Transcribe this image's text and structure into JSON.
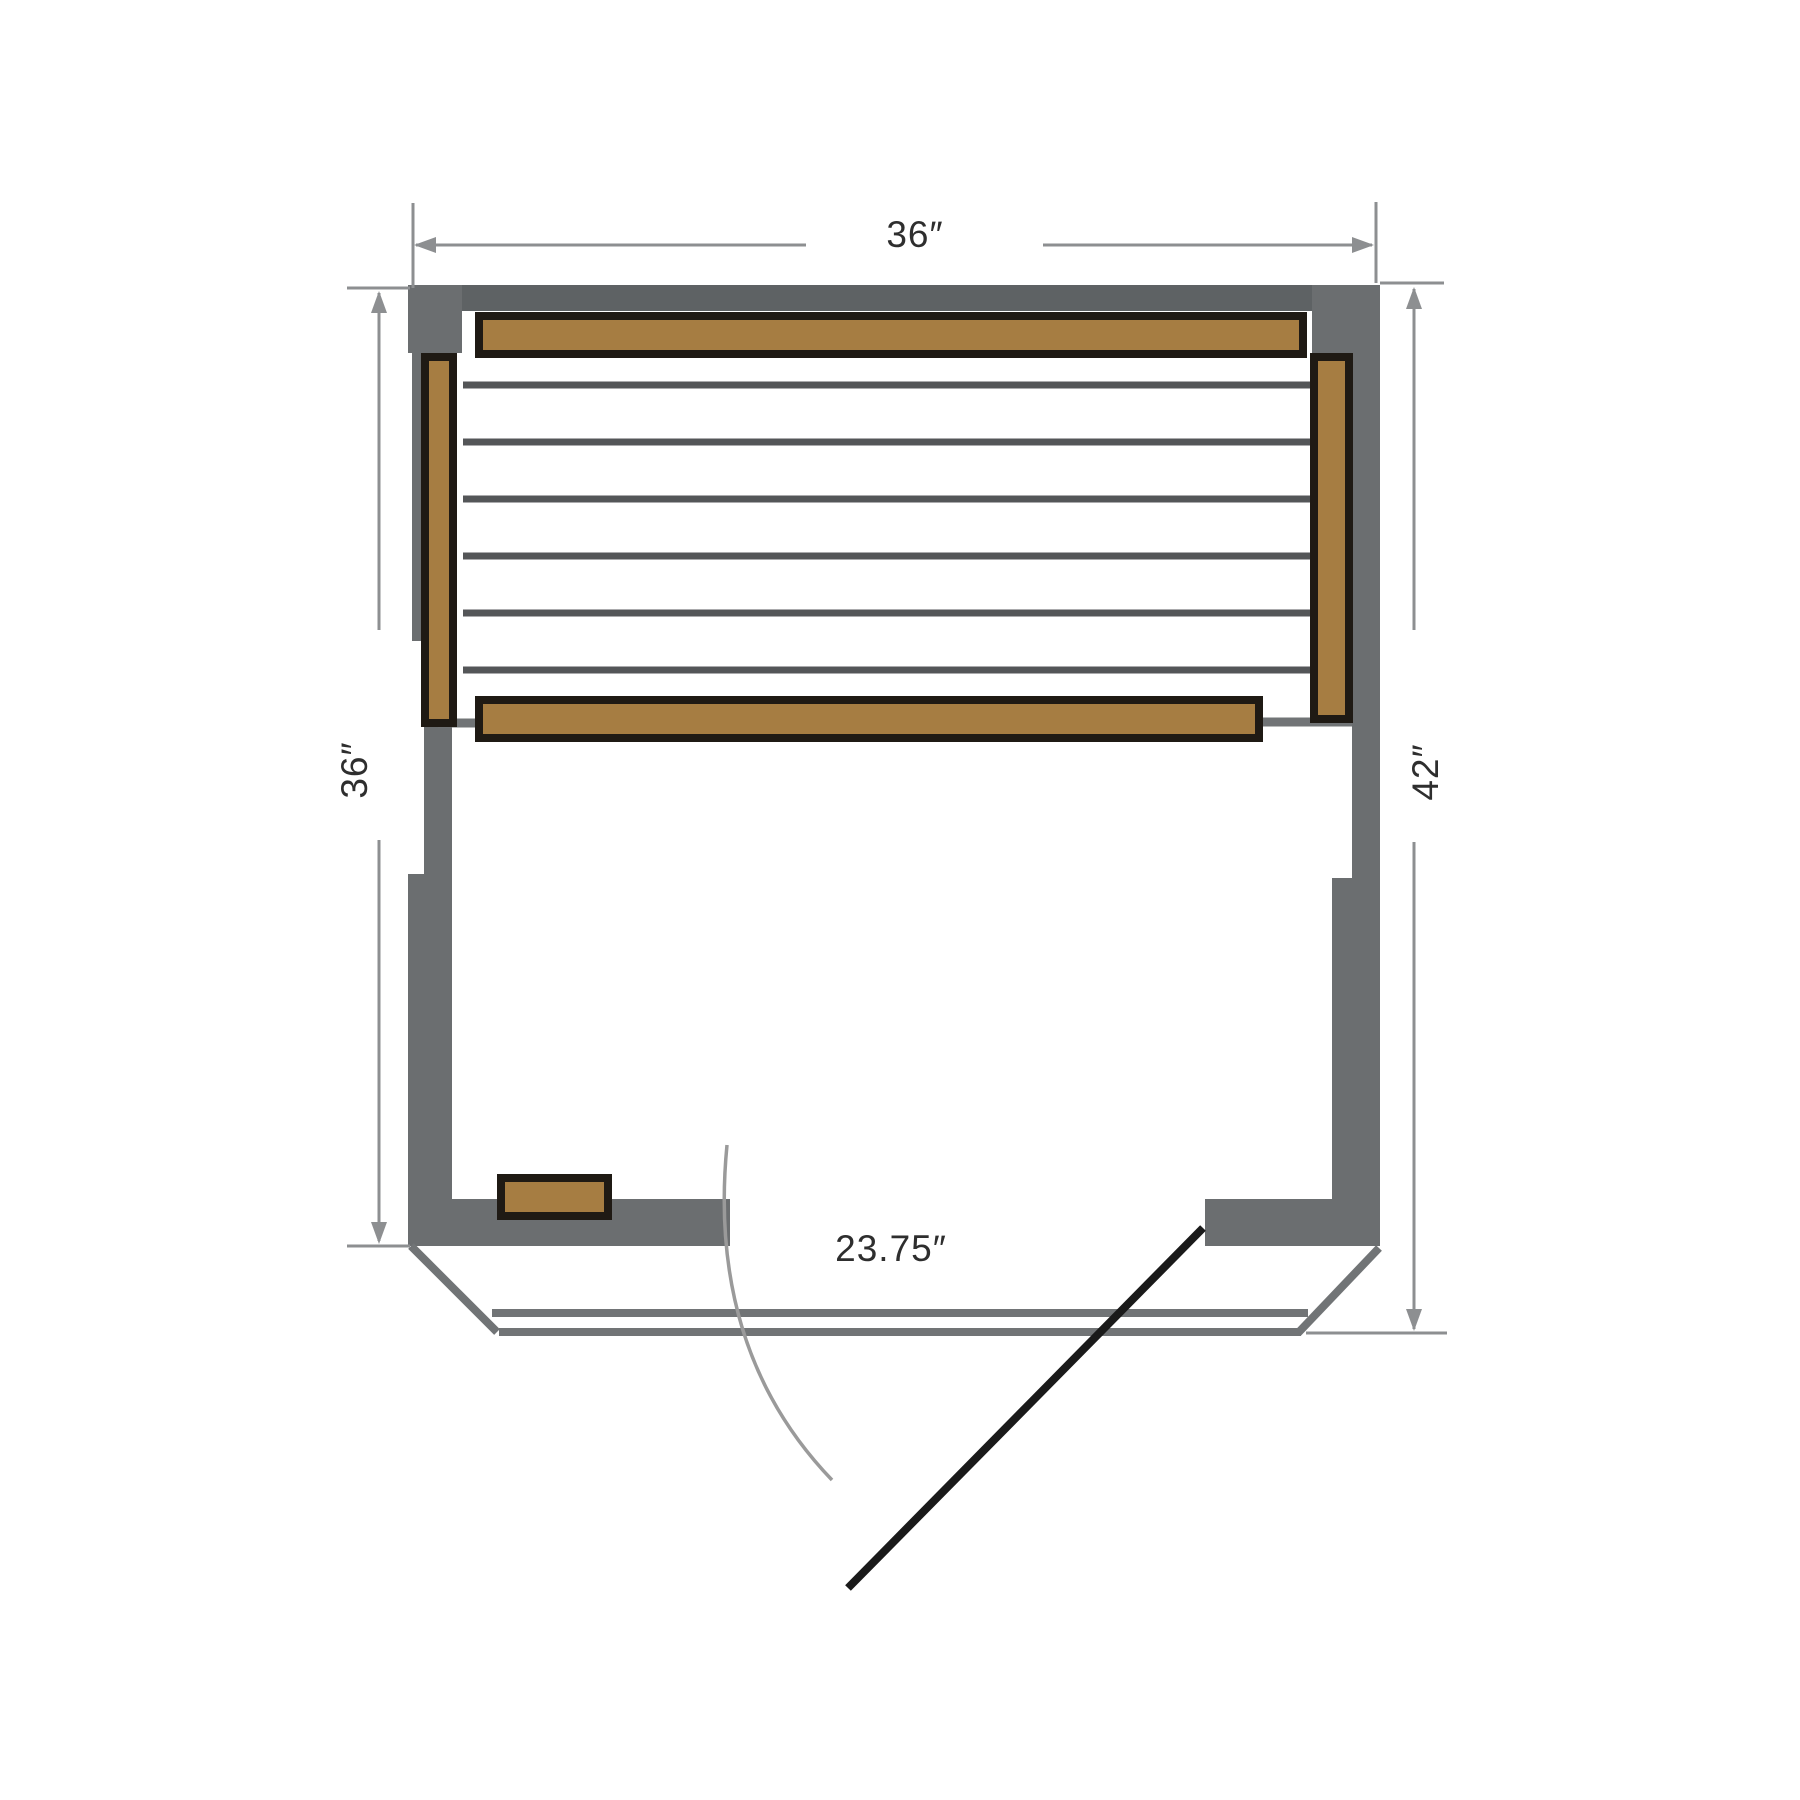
{
  "diagram": {
    "type": "sauna-floor-plan",
    "labels": {
      "top_width": "36″",
      "left_depth": "36″",
      "right_depth": "42″",
      "door_opening": "23.75″"
    },
    "colors": {
      "background": "#ffffff",
      "wall": "#6b6e70",
      "wall_top": "#5e6264",
      "wood": "#a67d42",
      "wood_border": "#1f1a14",
      "slat_line": "#545658",
      "panel_line": "#717476",
      "dimension_line": "#8d8f91",
      "door_arc": "#9a9a9a",
      "door_panel": "#1a1a1a",
      "label_text": "#2e2e2e"
    }
  }
}
